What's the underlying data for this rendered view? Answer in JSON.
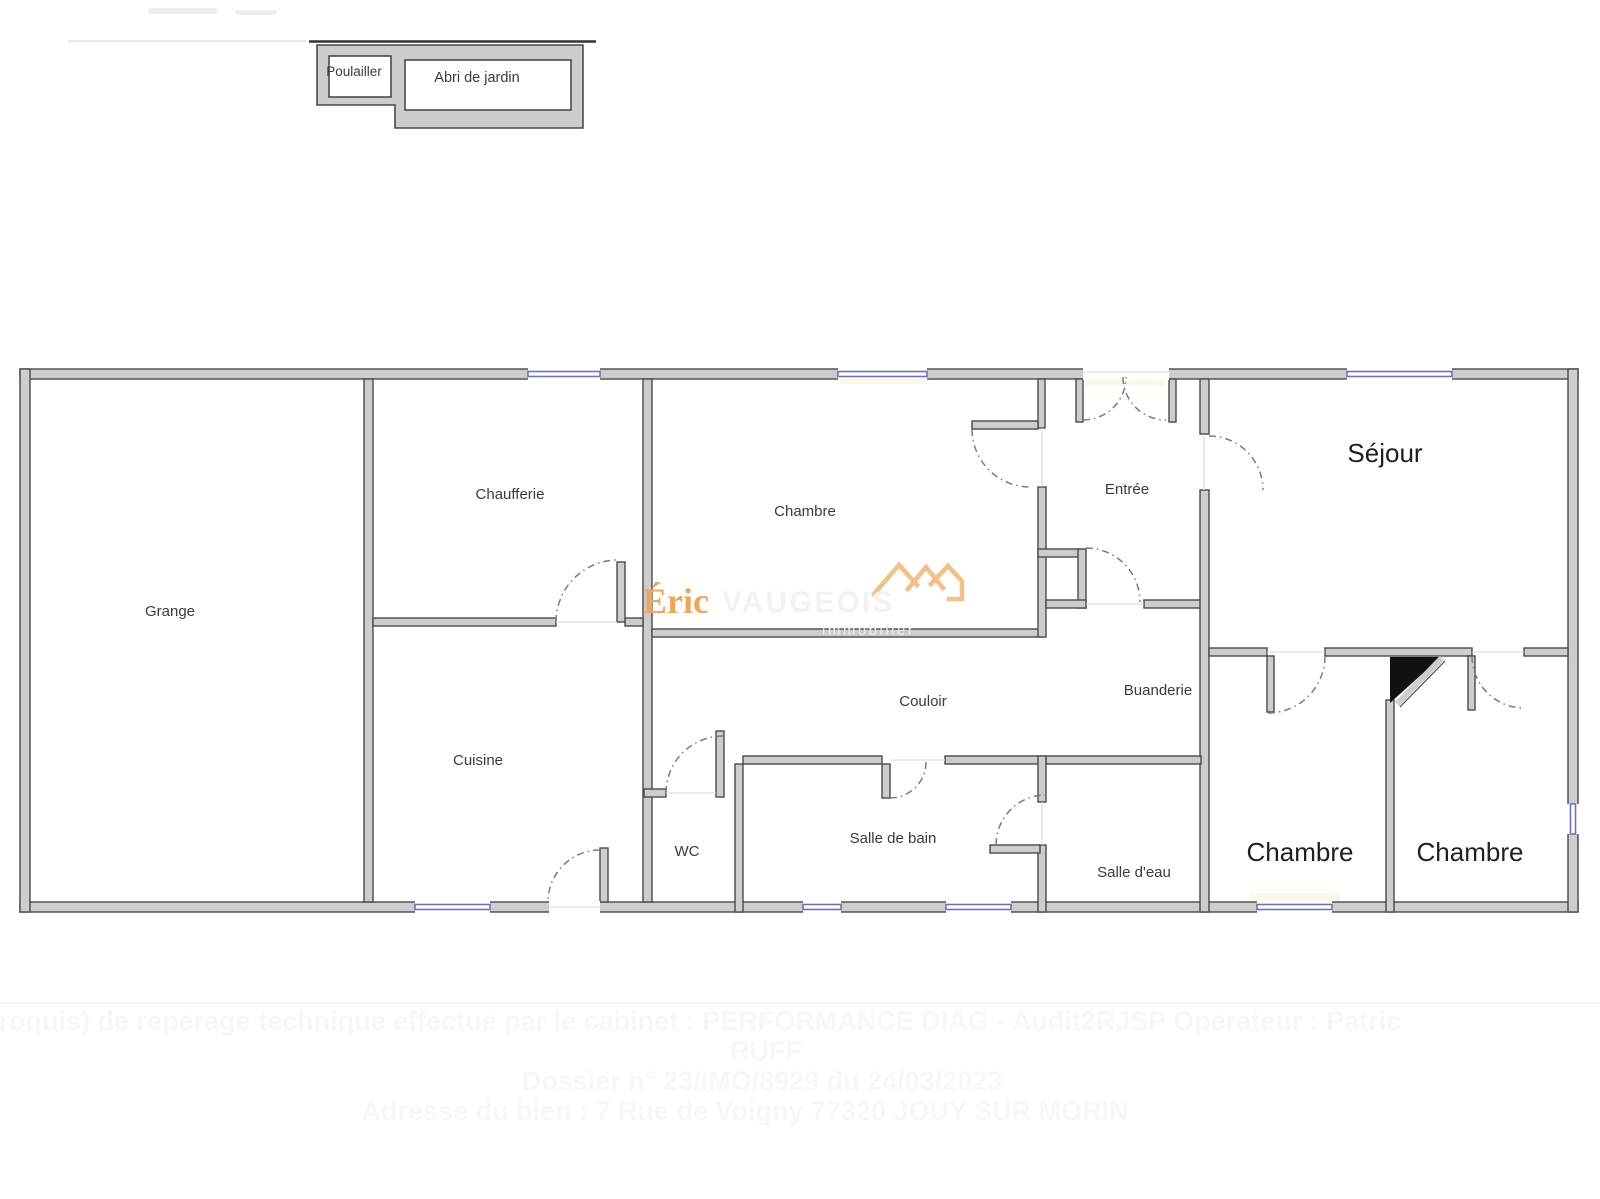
{
  "outbuildings": {
    "poulailler_label": "Poulailler",
    "abri_label": "Abri de jardin"
  },
  "rooms": {
    "grange": "Grange",
    "chaufferie": "Chaufferie",
    "chambre_top": "Chambre",
    "entree": "Entrée",
    "sejour": "Séjour",
    "couloir": "Couloir",
    "buanderie": "Buanderie",
    "cuisine": "Cuisine",
    "wc": "WC",
    "salle_de_bain": "Salle de bain",
    "salle_deau": "Salle d'eau",
    "chambre_left": "Chambre",
    "chambre_right": "Chambre"
  },
  "watermark": {
    "brand_first": "Éric",
    "brand_rest": "VAUGEOIS",
    "tagline": "immobilier"
  },
  "footer": {
    "line1": "Plan (croquis) de repérage technique effectué par le cabinet : PERFORMANCE DIAG - Audit2RJSP      Opérateur : Patric",
    "line2": "RUFF",
    "line3": "Dossier n° 23/IMO/8929 du 24/03/2023",
    "line4": "Adresse du bien : 7 Rue de Voigny  77320 JOUY SUR MORIN"
  },
  "colors": {
    "wall_fill": "#cdcdcd",
    "wall_edge": "#4a4a4a",
    "window_blue": "#6a74b0",
    "door_arc_gray": "#7b7b7b",
    "label_text": "#3a3a3a",
    "big_label_text": "#1f1f1f",
    "brand_orange": "#eca75e",
    "brand_ghost_white": "#f2f2f3",
    "roof_orange": "#f2c189",
    "footer_ghost": "#f6f7f7",
    "triangle_black": "#111111"
  }
}
